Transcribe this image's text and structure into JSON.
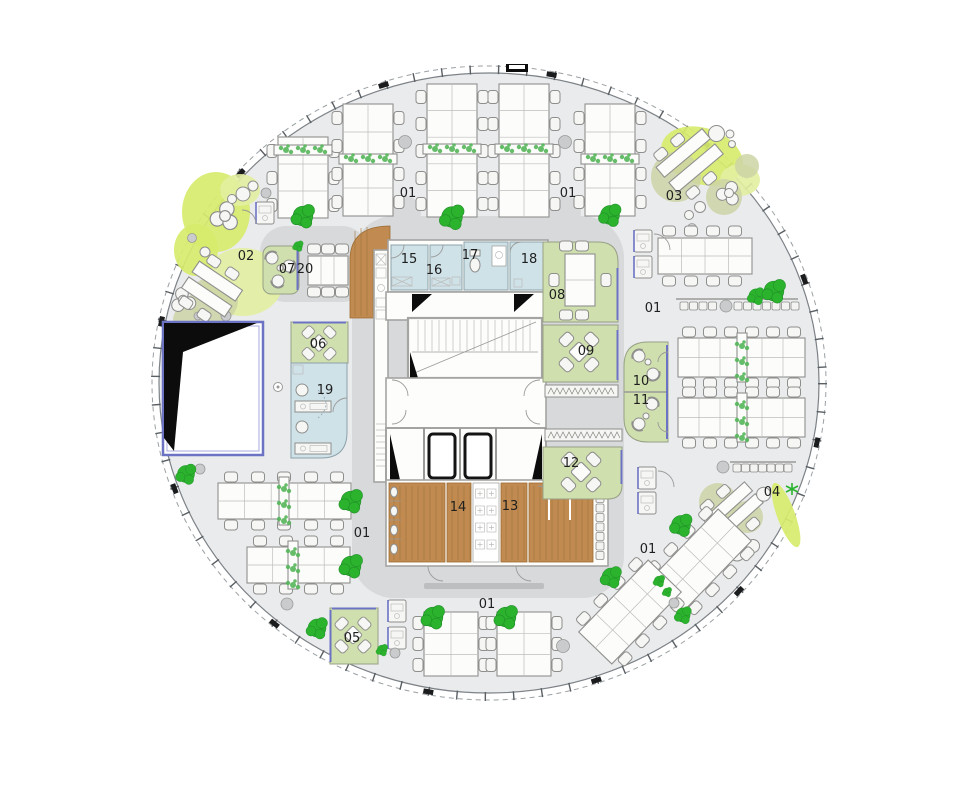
{
  "floor": {
    "type": "circular-office-floor-plan",
    "open_office": [
      "01",
      "01",
      "01",
      "01",
      "01",
      "01"
    ],
    "rooms": {
      "r02": "02",
      "r03": "03",
      "r04": "04",
      "r05": "05",
      "r06": "06",
      "r07": "07",
      "r08": "08",
      "r09": "09",
      "r10": "10",
      "r11": "11",
      "r12": "12",
      "r13": "13",
      "r14": "14",
      "r15": "15",
      "r16": "16",
      "r17": "17",
      "r18": "18",
      "r19": "19",
      "r20": "20"
    },
    "colors": {
      "floor_slab": "#e9ebed",
      "core_plate": "#d7d9db",
      "meeting_green": "#cfdfad",
      "washroom_blue": "#cfe2e8",
      "wood_floor": "#c08a50",
      "tree_green": "#2cb32e",
      "lawn_lime": "#d7eb6d",
      "sage_rug": "#ccd4a4",
      "accent_blue": "#6c73c4",
      "wall_gray": "#a4a4a2",
      "void_black": "#0c0c0c"
    }
  }
}
